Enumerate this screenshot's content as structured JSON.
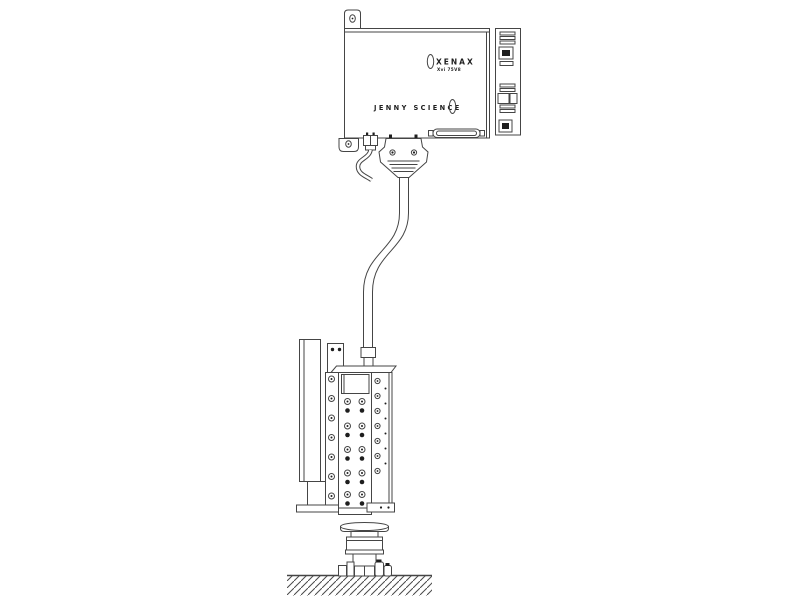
{
  "diagram": {
    "controller": {
      "logo_text": "XENAX",
      "model_text": "Xvi 75V8",
      "brand_text": "JENNY SCIENCE"
    },
    "colors": {
      "line": "#454545",
      "dark_fill": "#1e1e1e",
      "background": "#ffffff"
    }
  }
}
